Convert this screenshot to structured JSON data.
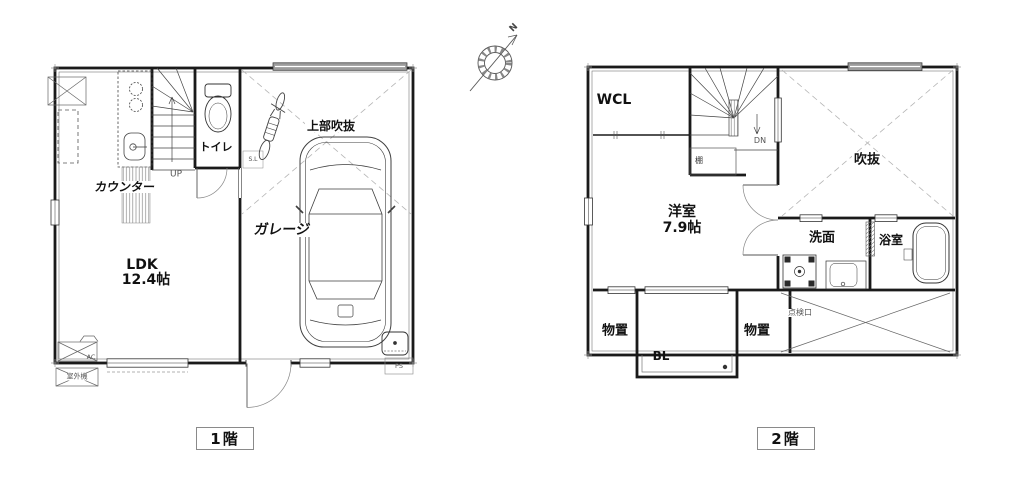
{
  "compass": {
    "north": "N"
  },
  "floor1": {
    "title": "1階",
    "labels": {
      "counter": "カウンター",
      "toilet": "トイレ",
      "stairs_up": "UP",
      "upper_void": "上部吹抜",
      "garage": "ガレージ",
      "ldk_name": "LDK",
      "ldk_size": "12.4帖",
      "ac_unit": "AC",
      "outdoor_unit": "室外機",
      "pipe_space": "PS",
      "sash_note": "S.L"
    }
  },
  "floor2": {
    "title": "2階",
    "labels": {
      "walkin_closet": "WCL",
      "stairs_down": "DN",
      "shelf": "棚",
      "void": "吹抜",
      "western_room_name": "洋室",
      "western_room_size": "7.9帖",
      "washroom": "洗面",
      "bathroom": "浴室",
      "storage_left": "物置",
      "balcony": "BL",
      "storage_right": "物置",
      "inspection_hatch": "点検口"
    }
  }
}
